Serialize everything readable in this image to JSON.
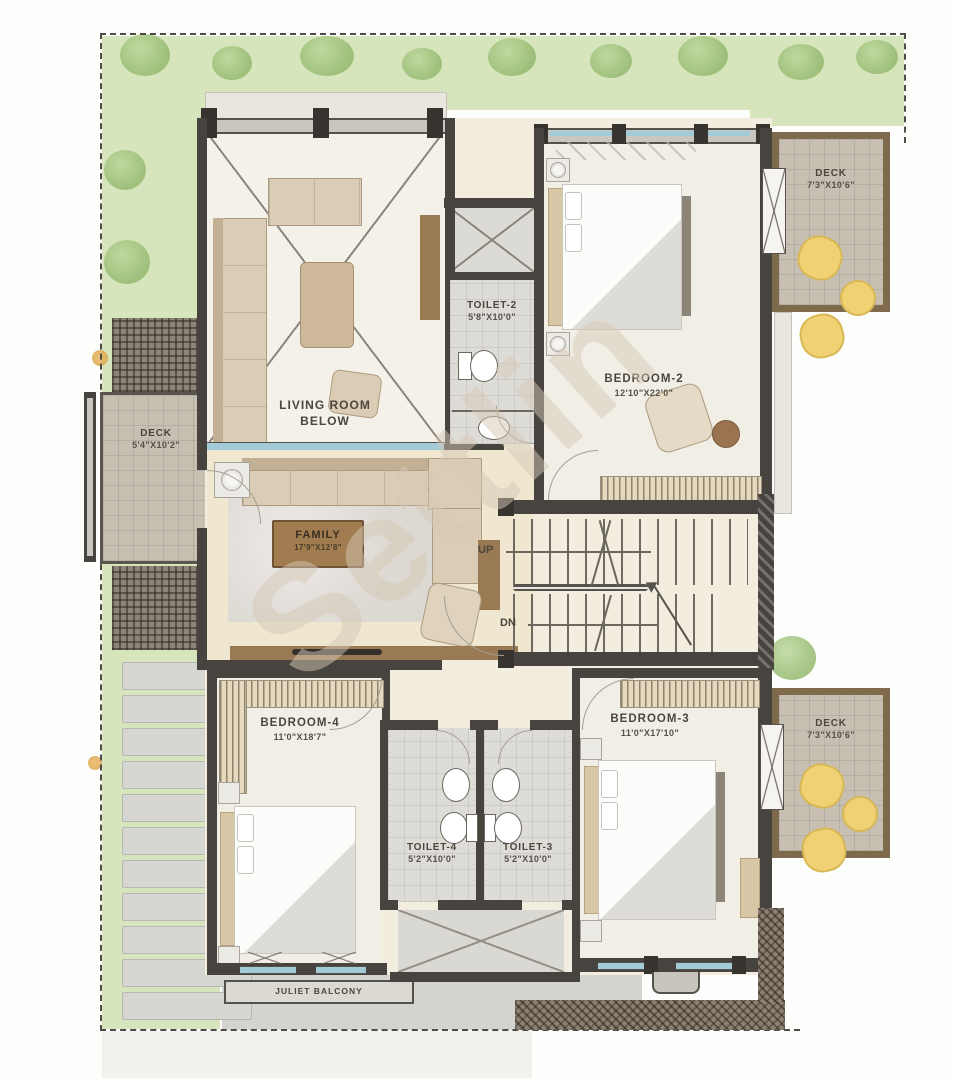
{
  "watermark": {
    "text": "Settlin"
  },
  "palette": {
    "wall": "#47433e",
    "floor_room": "#f1eee6",
    "floor_base": "#f2edde",
    "toilet_tile": "#dedcd7",
    "deck_tile": "#c6bfb2",
    "deck_border": "#7f6a4c",
    "grass": "#d6e5bc",
    "bush": "#94b96f",
    "bush_light": "#bcd69a",
    "stone": "#d6d6d2",
    "glass": "#a3cbd7",
    "pouf": "#f0d173",
    "wood": "#9a7a52"
  },
  "rooms": {
    "living": {
      "label": "LIVING ROOM\nBELOW"
    },
    "toilet2": {
      "label": "TOILET-2",
      "dims": "5'8\"X10'0\""
    },
    "bedroom2": {
      "label": "BEDROOM-2",
      "dims": "12'10\"X22'0\""
    },
    "deck_tr": {
      "label": "DECK",
      "dims": "7'3\"X10'6\""
    },
    "deck_left": {
      "label": "DECK",
      "dims": "5'4\"X10'2\""
    },
    "family": {
      "label": "FAMILY",
      "dims": "17'9\"X12'8\""
    },
    "bedroom4": {
      "label": "BEDROOM-4",
      "dims": "11'0\"X18'7\""
    },
    "toilet4": {
      "label": "TOILET-4",
      "dims": "5'2\"X10'0\""
    },
    "toilet3": {
      "label": "TOILET-3",
      "dims": "5'2\"X10'0\""
    },
    "bedroom3": {
      "label": "BEDROOM-3",
      "dims": "11'0\"X17'10\""
    },
    "deck_br": {
      "label": "DECK",
      "dims": "7'3\"X10'6\""
    },
    "juliet": {
      "label": "JULIET BALCONY"
    }
  },
  "stairs": {
    "up": "UP",
    "dn": "DN"
  }
}
